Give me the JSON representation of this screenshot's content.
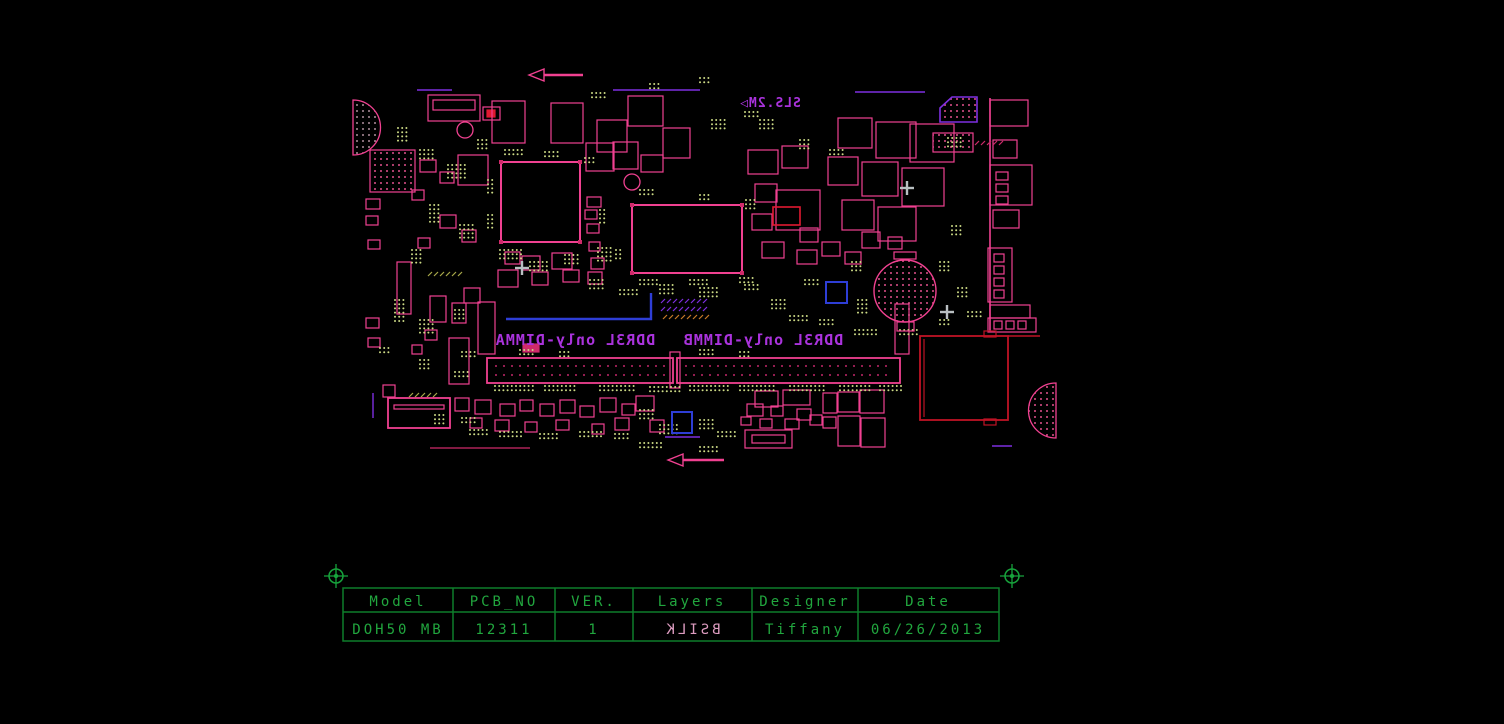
{
  "drawing": {
    "view": "bottom-silkscreen",
    "markings": {
      "top_marking": "SLS.2M▷",
      "top_marking_mirrored": true,
      "dimm_a_label": "DDR3L only-DIMMA",
      "dimm_b_label": "DDR3L only-DIMMB",
      "dimm_labels_mirrored": true
    }
  },
  "title_block": {
    "headers": [
      "Model",
      "PCB_NO",
      "VER.",
      "Layers",
      "Designer",
      "Date"
    ],
    "row": {
      "model": "DOH50 MB",
      "pcb_no": "12311",
      "ver": "1",
      "layers": "BSILK",
      "designer": "Tiffany",
      "date": "06/26/2013"
    },
    "layers_value_mirrored": true
  },
  "colors": {
    "background": "#000000",
    "silkscreen_pink": "#f14191",
    "silkscreen_dim_pink": "#cf2a6a",
    "label_purple": "#aa33dd",
    "line_purple": "#7e2fe0",
    "table_green_lines": "#0e7d2b",
    "table_green_text": "#21a63e",
    "accent_blue": "#2e3ed6",
    "accent_dark_red": "#bf1325",
    "accent_bright_red": "#e11931",
    "pad_dot_green": "#ccda85",
    "pad_dot_pink": "#e0508c",
    "layers_value_pink": "#dd9cc0"
  }
}
